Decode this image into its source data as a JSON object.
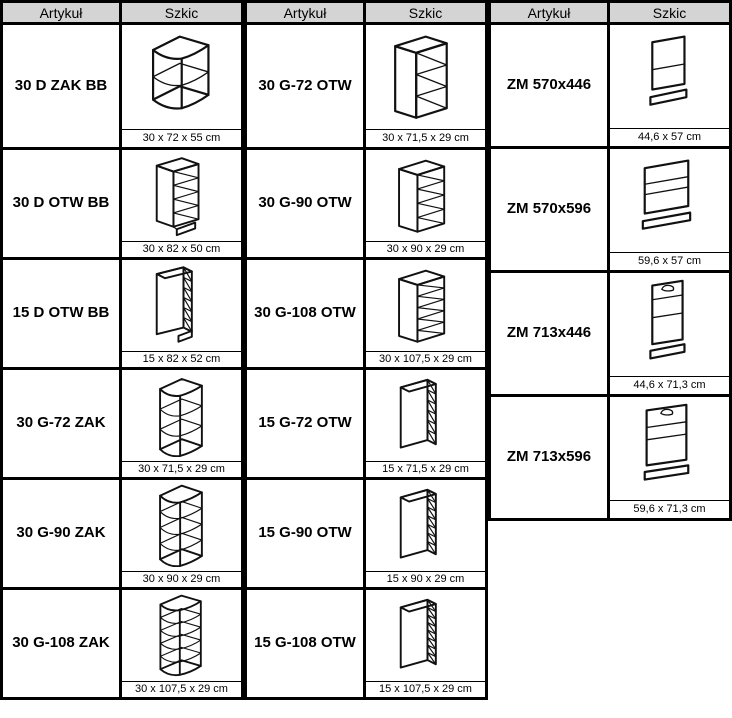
{
  "columns": {
    "article": "Artykuł",
    "sketch": "Szkic"
  },
  "colors": {
    "header_bg": "#d4d4d4",
    "border": "#000000",
    "ink": "#111111"
  },
  "tables": [
    {
      "rows": [
        {
          "article": "30 D ZAK BB",
          "dims": "30 x 72 x 55 cm",
          "sketch": "corner-shelf-2-levels"
        },
        {
          "article": "30 D OTW BB",
          "dims": "30 x 82 x 50 cm",
          "sketch": "open-rack-4-plinth"
        },
        {
          "article": "15 D OTW BB",
          "dims": "15 x 82 x 52 cm",
          "sketch": "narrow-rack-6-plinth"
        },
        {
          "article": "30 G-72 ZAK",
          "dims": "30 x 71,5 x 29 cm",
          "sketch": "corner-shelf-3-levels"
        },
        {
          "article": "30 G-90 ZAK",
          "dims": "30 x 90 x 29 cm",
          "sketch": "corner-shelf-4-levels"
        },
        {
          "article": "30 G-108 ZAK",
          "dims": "30 x 107,5 x 29 cm",
          "sketch": "corner-shelf-5-levels"
        }
      ]
    },
    {
      "rows": [
        {
          "article": "30 G-72 OTW",
          "dims": "30 x 71,5 x 29 cm",
          "sketch": "open-rack-3"
        },
        {
          "article": "30 G-90 OTW",
          "dims": "30 x 90 x 29 cm",
          "sketch": "open-rack-4"
        },
        {
          "article": "30 G-108 OTW",
          "dims": "30 x 107,5 x 29 cm",
          "sketch": "open-rack-5"
        },
        {
          "article": "15 G-72 OTW",
          "dims": "15 x 71,5 x 29 cm",
          "sketch": "narrow-rack-6"
        },
        {
          "article": "15 G-90 OTW",
          "dims": "15 x 90 x 29 cm",
          "sketch": "narrow-rack-7"
        },
        {
          "article": "15 G-108 OTW",
          "dims": "15 x 107,5 x 29 cm",
          "sketch": "narrow-rack-8"
        }
      ]
    },
    {
      "rows": [
        {
          "article": "ZM 570x446",
          "dims": "44,6 x 57 cm",
          "sketch": "drip-panel-1-line"
        },
        {
          "article": "ZM 570x596",
          "dims": "59,6 x 57 cm",
          "sketch": "drip-panel-2-lines"
        },
        {
          "article": "ZM 713x446",
          "dims": "44,6 x 71,3 cm",
          "sketch": "drip-panel-handle-narrow"
        },
        {
          "article": "ZM 713x596",
          "dims": "59,6 x 71,3 cm",
          "sketch": "drip-panel-handle-wide"
        }
      ]
    }
  ]
}
